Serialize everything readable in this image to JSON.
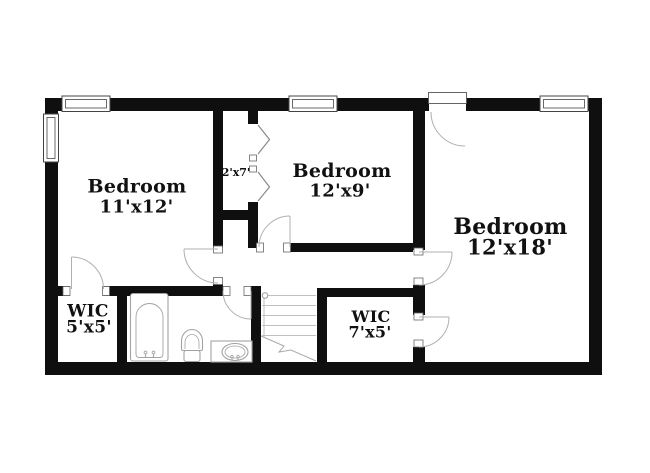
{
  "plan": {
    "rooms": {
      "bedroom_left": {
        "name": "Bedroom",
        "dims": "11'x12'"
      },
      "bedroom_middle": {
        "name": "Bedroom",
        "dims": "12'x9'"
      },
      "bedroom_right": {
        "name": "Bedroom",
        "dims": "12'x18'"
      },
      "closet": {
        "dims": "2'x7'"
      },
      "wic_left": {
        "name": "WIC",
        "dims": "5'x5'"
      },
      "wic_right": {
        "name": "WIC",
        "dims": "7'x5'"
      }
    },
    "fixtures": [
      "bathtub-icon",
      "toilet-icon",
      "sink-vanity-icon",
      "staircase-icon",
      "window-icon",
      "door-swing-icon",
      "bifold-door-icon"
    ],
    "colors": {
      "wall": "#0f0f0f",
      "door_outline": "#b0b0b0",
      "fixture_outline": "#a3a3a3",
      "stair_tread": "#c0c0c0",
      "label_text": "#111111",
      "background": "#ffffff"
    }
  }
}
